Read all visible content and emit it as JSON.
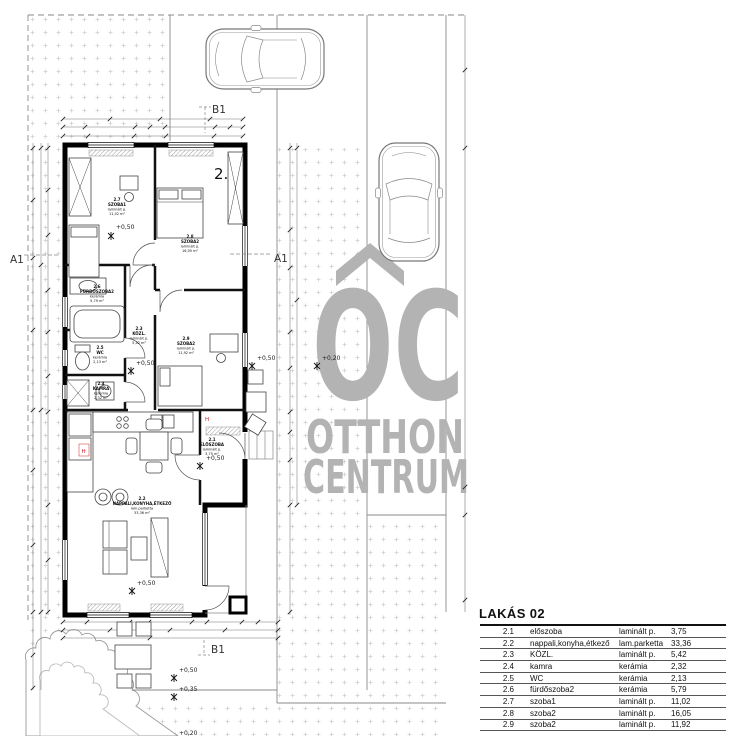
{
  "drawing": {
    "unit_number": "2.",
    "section_labels": {
      "b1": "B1",
      "a1": "A1"
    },
    "levels": {
      "p050": "+0,50",
      "p035": "+0,35",
      "p020": "+0,20"
    },
    "marker_h": "H",
    "rooms": [
      {
        "num": "2.1",
        "name": "ELŐSZOBA",
        "mat": "laminált p.",
        "plan_area": "3,75 m²"
      },
      {
        "num": "2.2",
        "name": "NAPPALI,KONYHA,ÉTKEZŐ",
        "mat": "lam.parketta",
        "plan_area": "33,36 m²"
      },
      {
        "num": "2.3",
        "name": "KÖZL.",
        "mat": "laminált p.",
        "plan_area": "5,42 m²"
      },
      {
        "num": "2.4",
        "name": "KAMRA",
        "mat": "kerámia",
        "plan_area": "2,32 m²"
      },
      {
        "num": "2.5",
        "name": "WC",
        "mat": "kerámia",
        "plan_area": "2,13 m²"
      },
      {
        "num": "2.6",
        "name": "FÜRDŐSZOBA2",
        "mat": "kerámia",
        "plan_area": "5,79 m²"
      },
      {
        "num": "2.7",
        "name": "SZOBA1",
        "mat": "laminált p.",
        "plan_area": "11,02 m²"
      },
      {
        "num": "2.8",
        "name": "SZOBA2",
        "mat": "laminált p.",
        "plan_area": "16,05 m²"
      },
      {
        "num": "2.9",
        "name": "SZOBA2",
        "mat": "laminált p.",
        "plan_area": "11,92 m²"
      }
    ]
  },
  "watermark": {
    "logo": "OC",
    "line1": "OTTHON",
    "line2": "CENTRUM",
    "color": "#b3b3b3"
  },
  "table": {
    "title": "LAKÁS 02",
    "rows": [
      {
        "num": "2.1",
        "name": "előszoba",
        "mat": "laminált p.",
        "area": "3,75"
      },
      {
        "num": "2.2",
        "name": "nappali,konyha,étkező",
        "mat": "lam.parketta",
        "area": "33,36"
      },
      {
        "num": "2.3",
        "name": "KÖZL.",
        "mat": "laminált p.",
        "area": "5,42"
      },
      {
        "num": "2.4",
        "name": "kamra",
        "mat": "kerámia",
        "area": "2,32"
      },
      {
        "num": "2.5",
        "name": "WC",
        "mat": "kerámia",
        "area": "2,13"
      },
      {
        "num": "2.6",
        "name": "fürdőszoba2",
        "mat": "kerámia",
        "area": "5,79"
      },
      {
        "num": "2.7",
        "name": "szoba1",
        "mat": "laminált p.",
        "area": "11,02"
      },
      {
        "num": "2.8",
        "name": "szoba2",
        "mat": "laminált p.",
        "area": "16,05"
      },
      {
        "num": "2.9",
        "name": "szoba2",
        "mat": "laminált p.",
        "area": "11,92"
      }
    ],
    "total": "91,76 m²"
  }
}
